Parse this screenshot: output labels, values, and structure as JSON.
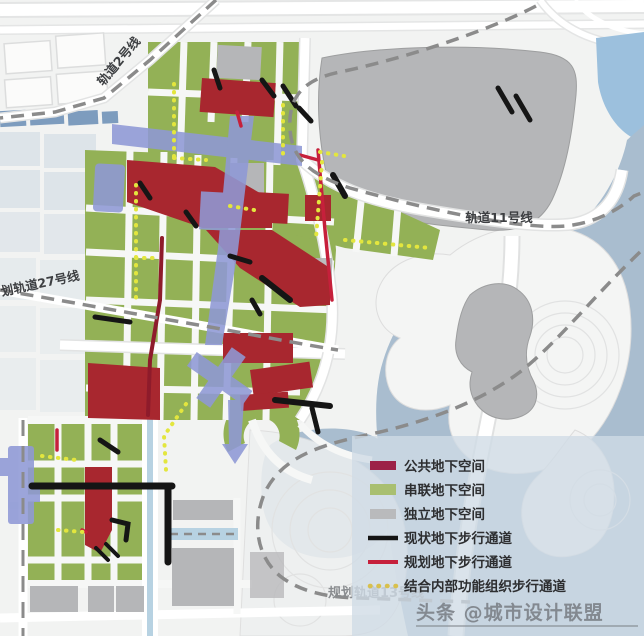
{
  "map": {
    "rail_labels": {
      "line2": "轨道2号线",
      "line11": "轨道11号线",
      "line27": "划轨道27号线",
      "line13": "规划轨道13号线"
    }
  },
  "legend": {
    "items": [
      {
        "label": "公共地下空间",
        "type": "area",
        "color": "#9c2147"
      },
      {
        "label": "串联地下空间",
        "type": "area",
        "color": "#a9bf70"
      },
      {
        "label": "独立地下空间",
        "type": "area",
        "color": "#b9babc"
      },
      {
        "label": "现状地下步行通道",
        "type": "line",
        "color": "#141414"
      },
      {
        "label": "规划地下步行通道",
        "type": "line",
        "color": "#c6203b"
      },
      {
        "label": "结合内部功能组织步行通道",
        "type": "dots",
        "color": "#d8c04d"
      }
    ]
  },
  "watermark": {
    "text": "头条 @城市设计联盟"
  },
  "colors": {
    "land": "#f2f3f2",
    "parcel_green": "#93b156",
    "parcel_red": "#a8272f",
    "parcel_gray": "#b5b6b8",
    "lavender": "#8f99d6",
    "water": "#a9bdcf",
    "water_bright": "#9cc0dd",
    "water_canal": "#b7d2e2",
    "black_passage": "#151515",
    "red_passage": "#c6203b",
    "maroon_passage": "#8e1b2b",
    "yellow_passage": "#e3e63e",
    "rail_dash": "#8b8b8b",
    "legend_panel": "#cfdbe6",
    "buildings_blue": "#7d9cbe",
    "parcel_light": "#dde4e9"
  }
}
